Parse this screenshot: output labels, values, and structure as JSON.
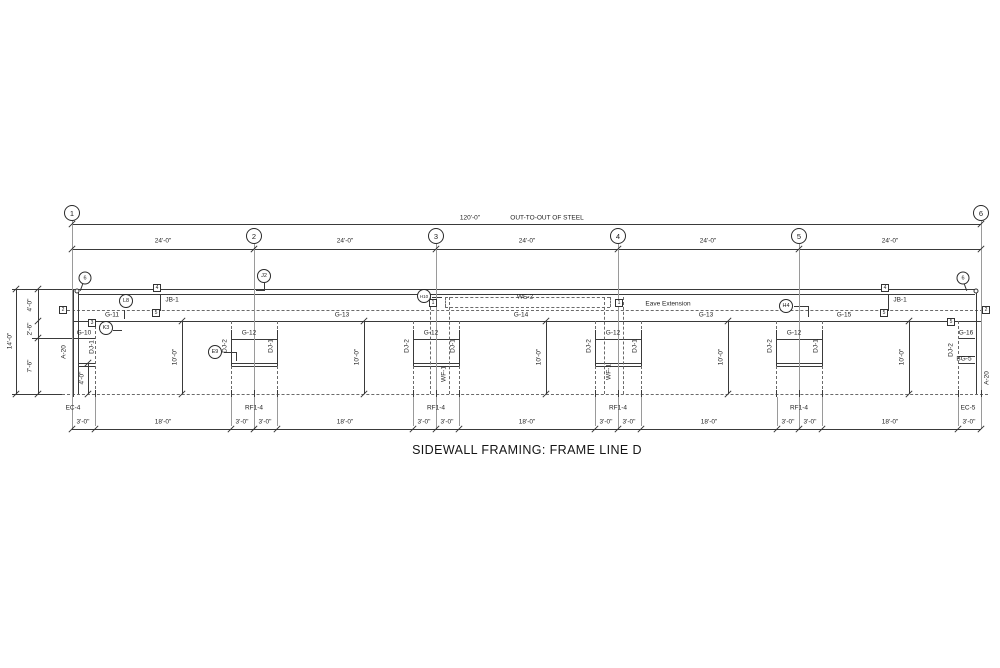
{
  "title": "SIDEWALL FRAMING: FRAME LINE D",
  "summary": {
    "overall_dimension": "120'-0\"",
    "overall_note": "OUT-TO-OUT OF STEEL",
    "bay_spacing": [
      "24'-0\"",
      "24'-0\"",
      "24'-0\"",
      "24'-0\"",
      "24'-0\""
    ],
    "grid_lines": [
      "1",
      "2",
      "3",
      "4",
      "5",
      "6"
    ],
    "eave_height": "14'-0\"",
    "left_height_segments": [
      "4'-0\"",
      "2'-6\"",
      "7'-6\""
    ],
    "column_height": "10'-0\"",
    "sill_height": "4'-0\"",
    "bottom_dims_pattern": [
      "3'-0\"",
      "18'-0\"",
      "3'-0\""
    ],
    "column_marks": [
      "EC-4",
      "RF1-4",
      "RF1-4",
      "RF1-4",
      "RF1-4",
      "EC-5"
    ],
    "member_marks": [
      "G-10",
      "G-11",
      "G-12",
      "G-13",
      "G-14",
      "G-15",
      "G-16",
      "WE-2",
      "JB-1",
      "DJ-1",
      "DJ-2",
      "WF-1",
      "BG-5",
      "A-20"
    ],
    "annotations": [
      "Eave Extension"
    ],
    "circle_callouts": [
      "6",
      "L8",
      "K3",
      "E9",
      "J2",
      "H10",
      "H4",
      "6"
    ],
    "square_clips": [
      "1",
      "2",
      "3",
      "4",
      "5"
    ]
  },
  "drawing": {
    "hlines": [
      [
        12,
        289,
        60
      ],
      [
        73,
        289,
        904
      ],
      [
        78,
        294,
        897
      ],
      [
        62,
        310,
        926,
        "d"
      ],
      [
        72,
        321,
        909
      ],
      [
        62,
        394,
        926,
        "d"
      ],
      [
        12,
        394,
        50
      ],
      [
        32,
        338,
        63
      ],
      [
        78,
        363,
        17
      ],
      [
        78,
        366,
        17
      ],
      [
        231,
        339,
        46
      ],
      [
        413,
        339,
        46
      ],
      [
        595,
        339,
        46
      ],
      [
        776,
        339,
        46
      ],
      [
        231,
        363,
        46
      ],
      [
        231,
        366,
        46
      ],
      [
        413,
        363,
        46
      ],
      [
        413,
        366,
        46
      ],
      [
        595,
        363,
        46
      ],
      [
        595,
        366,
        46
      ],
      [
        776,
        363,
        46
      ],
      [
        776,
        366,
        46
      ],
      [
        958,
        338,
        17
      ],
      [
        958,
        356,
        17
      ],
      [
        958,
        363,
        17
      ],
      [
        445,
        297,
        165,
        "d"
      ],
      [
        445,
        307,
        165,
        "d"
      ],
      [
        72,
        224,
        909
      ],
      [
        72,
        249,
        909
      ],
      [
        72,
        429,
        909
      ],
      [
        113,
        330,
        9
      ],
      [
        224,
        352,
        12
      ],
      [
        432,
        297,
        10
      ],
      [
        256,
        290,
        8
      ],
      [
        794,
        306,
        14
      ]
    ],
    "vlines": [
      [
        16,
        289,
        105
      ],
      [
        38,
        289,
        105
      ],
      [
        73,
        289,
        105
      ],
      [
        78,
        289,
        105
      ],
      [
        95,
        321,
        73,
        "d"
      ],
      [
        88,
        363,
        31
      ],
      [
        231,
        321,
        73,
        "d"
      ],
      [
        277,
        321,
        73,
        "d"
      ],
      [
        231,
        330,
        36
      ],
      [
        277,
        330,
        36
      ],
      [
        413,
        321,
        73,
        "d"
      ],
      [
        459,
        321,
        73,
        "d"
      ],
      [
        413,
        330,
        36
      ],
      [
        459,
        330,
        36
      ],
      [
        595,
        321,
        73,
        "d"
      ],
      [
        641,
        321,
        73,
        "d"
      ],
      [
        595,
        330,
        36
      ],
      [
        641,
        330,
        36
      ],
      [
        776,
        321,
        73,
        "d"
      ],
      [
        822,
        321,
        73,
        "d"
      ],
      [
        776,
        330,
        36
      ],
      [
        822,
        330,
        36
      ],
      [
        430,
        297,
        97,
        "d"
      ],
      [
        449,
        297,
        97,
        "d"
      ],
      [
        604,
        297,
        97,
        "d"
      ],
      [
        623,
        297,
        97,
        "d"
      ],
      [
        445,
        297,
        10,
        "d"
      ],
      [
        610,
        297,
        10,
        "d"
      ],
      [
        976,
        289,
        105
      ],
      [
        981,
        289,
        105
      ],
      [
        958,
        321,
        73,
        "d"
      ],
      [
        72,
        221,
        208,
        "g"
      ],
      [
        254,
        244,
        185,
        "g"
      ],
      [
        436,
        244,
        185,
        "g"
      ],
      [
        618,
        244,
        185,
        "g"
      ],
      [
        799,
        244,
        185,
        "g"
      ],
      [
        981,
        221,
        208,
        "g"
      ],
      [
        182,
        321,
        73
      ],
      [
        364,
        321,
        73
      ],
      [
        546,
        321,
        73
      ],
      [
        728,
        321,
        73
      ],
      [
        909,
        321,
        73
      ],
      [
        160,
        294,
        17
      ],
      [
        888,
        294,
        17
      ],
      [
        124,
        310,
        9
      ],
      [
        236,
        352,
        9
      ],
      [
        264,
        283,
        8
      ],
      [
        808,
        306,
        11
      ],
      [
        95,
        397,
        29,
        "g"
      ],
      [
        231,
        397,
        29,
        "g"
      ],
      [
        277,
        397,
        29,
        "g"
      ],
      [
        413,
        397,
        29,
        "g"
      ],
      [
        459,
        397,
        29,
        "g"
      ],
      [
        595,
        397,
        29,
        "g"
      ],
      [
        641,
        397,
        29,
        "g"
      ],
      [
        777,
        397,
        29,
        "g"
      ],
      [
        822,
        397,
        29,
        "g"
      ],
      [
        958,
        397,
        29,
        "g"
      ],
      [
        231,
        390,
        7
      ],
      [
        254,
        390,
        7
      ],
      [
        277,
        390,
        7
      ],
      [
        413,
        390,
        7
      ],
      [
        436,
        390,
        7
      ],
      [
        459,
        390,
        7
      ],
      [
        595,
        390,
        7
      ],
      [
        618,
        390,
        7
      ],
      [
        641,
        390,
        7
      ],
      [
        776,
        390,
        7
      ],
      [
        799,
        390,
        7
      ],
      [
        822,
        390,
        7
      ],
      [
        73,
        390,
        7
      ],
      [
        95,
        390,
        7
      ],
      [
        958,
        390,
        7
      ],
      [
        981,
        390,
        7
      ]
    ],
    "ticks": [
      [
        72,
        224
      ],
      [
        981,
        224
      ],
      [
        72,
        249
      ],
      [
        254,
        249
      ],
      [
        436,
        249
      ],
      [
        618,
        249
      ],
      [
        799,
        249
      ],
      [
        981,
        249
      ],
      [
        72,
        429
      ],
      [
        95,
        429
      ],
      [
        231,
        429
      ],
      [
        254,
        429
      ],
      [
        277,
        429
      ],
      [
        413,
        429
      ],
      [
        436,
        429
      ],
      [
        459,
        429
      ],
      [
        595,
        429
      ],
      [
        618,
        429
      ],
      [
        641,
        429
      ],
      [
        777,
        429
      ],
      [
        799,
        429
      ],
      [
        822,
        429
      ],
      [
        958,
        429
      ],
      [
        981,
        429
      ],
      [
        38,
        289
      ],
      [
        38,
        321
      ],
      [
        38,
        338
      ],
      [
        38,
        394
      ],
      [
        16,
        289
      ],
      [
        16,
        394
      ],
      [
        182,
        321
      ],
      [
        182,
        394
      ],
      [
        364,
        321
      ],
      [
        364,
        394
      ],
      [
        546,
        321
      ],
      [
        546,
        394
      ],
      [
        728,
        321
      ],
      [
        728,
        394
      ],
      [
        909,
        321
      ],
      [
        909,
        394
      ],
      [
        88,
        363
      ],
      [
        88,
        394
      ]
    ],
    "dlines": [
      [
        84,
        280,
        11,
        110
      ],
      [
        963,
        280,
        11,
        70
      ]
    ],
    "nodes": [
      [
        77,
        291
      ],
      [
        976,
        291
      ]
    ],
    "texts": [
      [
        "120'-0\"",
        470,
        218
      ],
      [
        "OUT-TO-OUT OF STEEL",
        547,
        218
      ],
      [
        "24'-0\"",
        163,
        241
      ],
      [
        "24'-0\"",
        345,
        241
      ],
      [
        "24'-0\"",
        527,
        241
      ],
      [
        "24'-0\"",
        708,
        241
      ],
      [
        "24'-0\"",
        890,
        241
      ],
      [
        "G-11",
        112,
        315
      ],
      [
        "G-13",
        342,
        315
      ],
      [
        "G-14",
        521,
        315
      ],
      [
        "G-13",
        706,
        315
      ],
      [
        "G-15",
        844,
        315
      ],
      [
        "G-10",
        84,
        333
      ],
      [
        "G-16",
        966,
        333
      ],
      [
        "BG-5",
        964,
        359
      ],
      [
        "G-12",
        249,
        333
      ],
      [
        "G-12",
        431,
        333
      ],
      [
        "G-12",
        613,
        333
      ],
      [
        "G-12",
        794,
        333
      ],
      [
        "WE-2",
        525,
        297
      ],
      [
        "Eave Extension",
        668,
        304
      ],
      [
        "JB-1",
        172,
        300
      ],
      [
        "JB-1",
        900,
        300
      ],
      [
        "EC-4",
        73,
        408
      ],
      [
        "RF1-4",
        254,
        408
      ],
      [
        "RF1-4",
        436,
        408
      ],
      [
        "RF1-4",
        618,
        408
      ],
      [
        "RF1-4",
        799,
        408
      ],
      [
        "EC-5",
        968,
        408
      ],
      [
        "3'-0\"",
        83,
        422
      ],
      [
        "18'-0\"",
        163,
        422
      ],
      [
        "3'-0\"",
        242,
        422
      ],
      [
        "3'-0\"",
        265,
        422
      ],
      [
        "18'-0\"",
        345,
        422
      ],
      [
        "3'-0\"",
        424,
        422
      ],
      [
        "3'-0\"",
        447,
        422
      ],
      [
        "18'-0\"",
        527,
        422
      ],
      [
        "3'-0\"",
        606,
        422
      ],
      [
        "3'-0\"",
        629,
        422
      ],
      [
        "18'-0\"",
        709,
        422
      ],
      [
        "3'-0\"",
        788,
        422
      ],
      [
        "3'-0\"",
        810,
        422
      ],
      [
        "18'-0\"",
        890,
        422
      ],
      [
        "3'-0\"",
        969,
        422
      ],
      [
        "14'-0\"",
        10,
        341,
        1
      ],
      [
        "4'-0\"",
        30,
        305,
        1
      ],
      [
        "2'-6\"",
        30,
        329,
        1
      ],
      [
        "7'-6\"",
        30,
        366,
        1
      ],
      [
        "4'-0\"",
        82,
        378,
        1
      ],
      [
        "10'-0\"",
        175,
        357,
        1
      ],
      [
        "10'-0\"",
        357,
        357,
        1
      ],
      [
        "10'-0\"",
        539,
        357,
        1
      ],
      [
        "10'-0\"",
        721,
        357,
        1
      ],
      [
        "10'-0\"",
        902,
        357,
        1
      ],
      [
        "A-20",
        64,
        352,
        1
      ],
      [
        "A-20",
        987,
        378,
        1
      ],
      [
        "DJ-1",
        92,
        347,
        1
      ],
      [
        "DJ-2",
        951,
        350,
        1
      ],
      [
        "DJ-2",
        225,
        346,
        1
      ],
      [
        "DJ-1",
        271,
        346,
        1
      ],
      [
        "DJ-2",
        407,
        346,
        1
      ],
      [
        "DJ-1",
        453,
        346,
        1
      ],
      [
        "DJ-2",
        589,
        346,
        1
      ],
      [
        "DJ-1",
        635,
        346,
        1
      ],
      [
        "DJ-2",
        770,
        346,
        1
      ],
      [
        "DJ-1",
        816,
        346,
        1
      ],
      [
        "WF-1",
        444,
        374,
        1
      ],
      [
        "WF-1",
        609,
        372,
        1
      ]
    ],
    "bubbles": [
      [
        72,
        213,
        "1"
      ],
      [
        254,
        236,
        "2"
      ],
      [
        436,
        236,
        "3"
      ],
      [
        618,
        236,
        "4"
      ],
      [
        799,
        236,
        "5"
      ],
      [
        981,
        213,
        "6"
      ]
    ],
    "callouts": [
      [
        85,
        278,
        13,
        "6"
      ],
      [
        963,
        278,
        13,
        "6"
      ],
      [
        126,
        301,
        14,
        "L8"
      ],
      [
        106,
        328,
        14,
        "K3"
      ],
      [
        215,
        352,
        14,
        "E9"
      ],
      [
        264,
        276,
        14,
        "J2"
      ],
      [
        424,
        296,
        14,
        "H10"
      ],
      [
        786,
        306,
        14,
        "H4"
      ]
    ],
    "squares": [
      [
        63,
        310,
        "2"
      ],
      [
        986,
        310,
        "2"
      ],
      [
        92,
        323,
        "3"
      ],
      [
        157,
        288,
        "4"
      ],
      [
        156,
        313,
        "5"
      ],
      [
        885,
        288,
        "4"
      ],
      [
        884,
        313,
        "5"
      ],
      [
        433,
        303,
        "1"
      ],
      [
        619,
        303,
        "1"
      ],
      [
        951,
        322,
        "5"
      ]
    ]
  }
}
